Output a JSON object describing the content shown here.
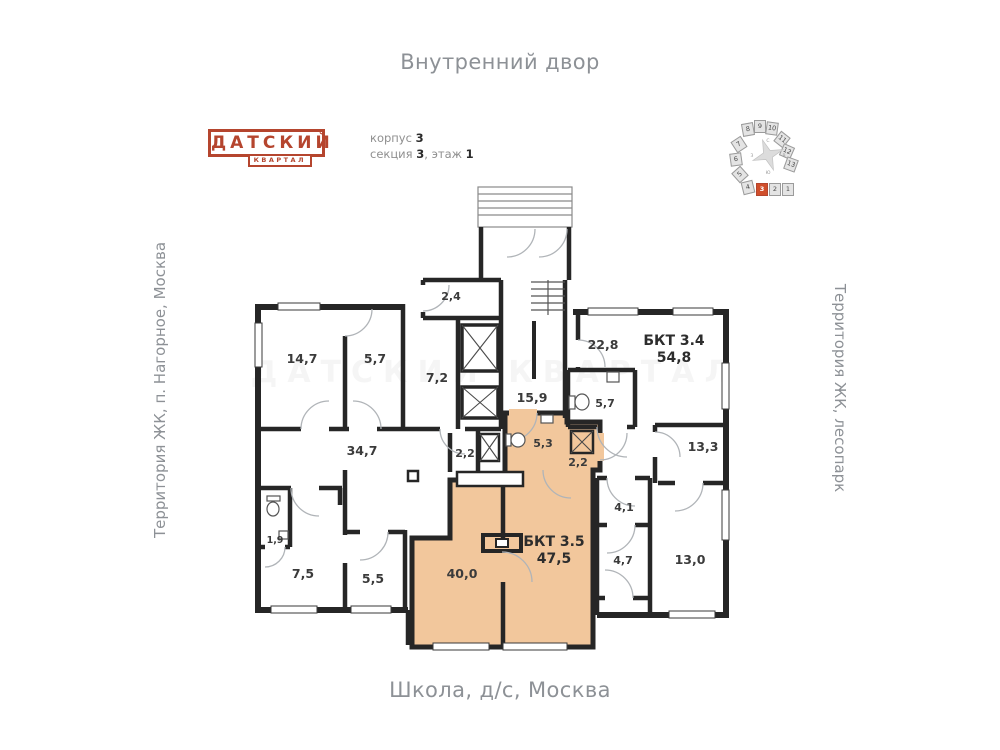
{
  "page": {
    "top_label": "Внутренний двор",
    "bottom_label": "Школа, д/с, Москва",
    "left_label": "Территория ЖК, п. Нагорное, Москва",
    "right_label": "Территория ЖК, лесопарк"
  },
  "logo": {
    "title": "ДАТСКИЙ",
    "subtitle": "КВАРТАЛ",
    "color": "#b5452e"
  },
  "meta": {
    "korpus_label": "корпус",
    "korpus_value": "3",
    "sekciya_label": "секция",
    "sekciya_value": "3",
    "sep": ", ",
    "etazh_label": "этаж",
    "etazh_value": "1"
  },
  "minimap": {
    "highlighted_section": "3",
    "highlight_color": "#d04f2c",
    "sections": [
      {
        "label": "1"
      },
      {
        "label": "2"
      },
      {
        "label": "3"
      },
      {
        "label": "4"
      },
      {
        "label": "5"
      },
      {
        "label": "6"
      },
      {
        "label": "7"
      },
      {
        "label": "8"
      },
      {
        "label": "9"
      },
      {
        "label": "10"
      },
      {
        "label": "11"
      },
      {
        "label": "12"
      },
      {
        "label": "13"
      }
    ],
    "compass": {
      "n": "С",
      "e": "В",
      "s": "Ю",
      "w": "З"
    }
  },
  "plan": {
    "highlight_color": "#f2c79c",
    "watermark": "ДАТСКИЙ КВАРТАЛ",
    "units": [
      {
        "label": "БКТ 3.4",
        "area": "54,8"
      },
      {
        "label": "БКТ 3.5",
        "area": "47,5"
      }
    ],
    "rooms": [
      {
        "area": "14,7"
      },
      {
        "area": "5,7"
      },
      {
        "area": "2,4"
      },
      {
        "area": "7,2"
      },
      {
        "area": "15,9"
      },
      {
        "area": "22,8"
      },
      {
        "area": "5,7"
      },
      {
        "area": "5,3"
      },
      {
        "area": "2,2"
      },
      {
        "area": "2,2"
      },
      {
        "area": "13,3"
      },
      {
        "area": "34,7"
      },
      {
        "area": "4,1"
      },
      {
        "area": "4,7"
      },
      {
        "area": "13,0"
      },
      {
        "area": "1,9"
      },
      {
        "area": "7,5"
      },
      {
        "area": "5,5"
      },
      {
        "area": "40,0"
      }
    ]
  }
}
